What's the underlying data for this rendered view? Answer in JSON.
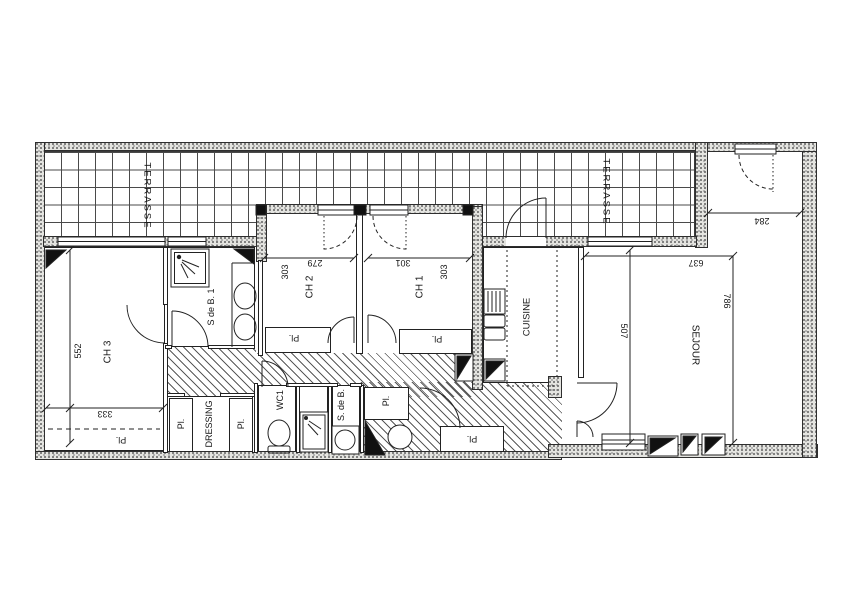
{
  "plan": {
    "terrace_left": {
      "label": "TERRASSE"
    },
    "terrace_right": {
      "label": "TERRASSE"
    },
    "ch3": {
      "label": "CH 3",
      "dim_width": "333",
      "dim_height": "552",
      "pl": "Pl."
    },
    "sdb1": {
      "label": "S de B. 1"
    },
    "dressing": {
      "label": "DRESSING",
      "pl_left": "Pl.",
      "pl_right": "Pl."
    },
    "wc": {
      "label": "WC1"
    },
    "sdb2": {
      "label": "S. de B.",
      "pl": "Pl."
    },
    "ch2": {
      "label": "CH 2",
      "dim_width": "279",
      "dim_height": "303",
      "pl": "Pl."
    },
    "ch1": {
      "label": "CH 1",
      "dim_width": "301",
      "dim_height": "303",
      "pl": "Pl."
    },
    "cuisine": {
      "label": "CUISINE"
    },
    "entry": {
      "pl": "Pl."
    },
    "sejour": {
      "label": "SEJOUR",
      "dim_top": "284",
      "dim_width": "637",
      "dim_height": "786",
      "dim_inner": "507"
    }
  }
}
